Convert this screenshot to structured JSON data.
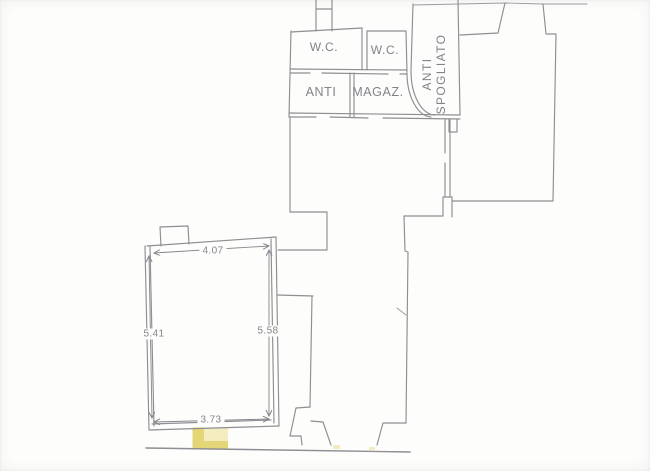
{
  "plan": {
    "rooms": {
      "wc_left": {
        "label": "W.C."
      },
      "wc_right": {
        "label": "W.C."
      },
      "anti": {
        "label": "ANTI"
      },
      "magaz": {
        "label": "MAGAZ."
      },
      "anti_spogliato": {
        "line1": "ANTI",
        "line2": "SPOGLIATO"
      }
    },
    "dimensions": {
      "top_width": "4.07",
      "left_height": "5.41",
      "right_height": "5.58",
      "bottom_width": "3.73"
    },
    "colors": {
      "paper": "#fdfdfc",
      "ink": "#8e8e93",
      "ink2": "#9b9ba0",
      "dim": "#85858a",
      "hl": "#e4d677",
      "hl2": "#f4efc8"
    }
  }
}
